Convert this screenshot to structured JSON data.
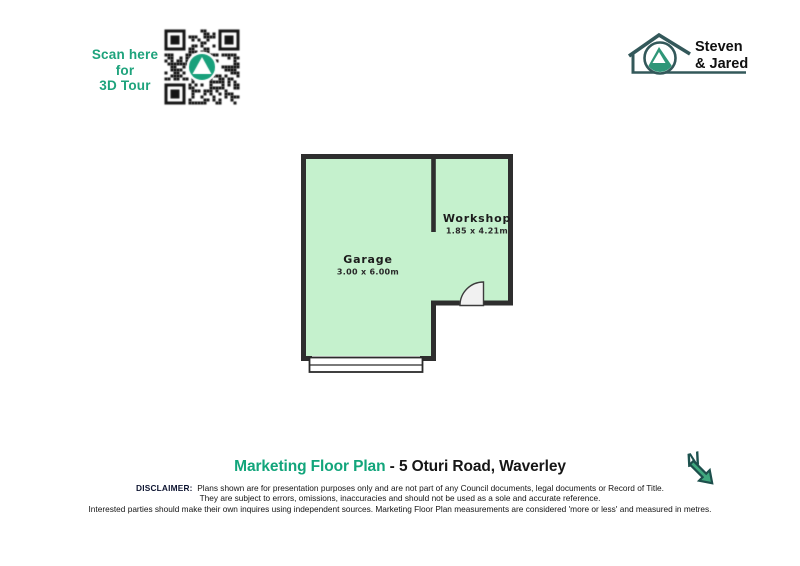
{
  "scan_cta": {
    "lines": [
      "Scan here",
      "for",
      "3D Tour"
    ]
  },
  "qr": {
    "icon": "qr-code-with-mountain-logo"
  },
  "brand": {
    "name_line1": "Steven",
    "name_line2": "& Jared",
    "icon": "house-mountain-logo"
  },
  "floorplan": {
    "rooms": [
      {
        "name": "Garage",
        "dims": "3.00 x 6.00m"
      },
      {
        "name": "Workshop",
        "dims": "1.85 x 4.21m"
      }
    ]
  },
  "footer": {
    "title_highlight": "Marketing Floor Plan",
    "title_rest": "- 5 Oturi Road, Waverley",
    "disclaimer_label": "DISCLAIMER:",
    "disclaimer_lines": [
      "Plans shown are for presentation purposes only and are not part of any Council documents, legal documents or Record of Title.",
      "They are subject to errors, omissions, inaccuracies and should not be used as a sole and accurate reference.",
      "Interested parties should make their own inquires using independent sources.  Marketing Floor Plan measurements are considered 'more or less' and measured in metres."
    ],
    "compass_letter": "N"
  },
  "colors": {
    "accent_teal": "#18a07b",
    "title_green": "#12a57b",
    "floor_fill": "#c5f1cd",
    "wall_dark": "#2e2e2e",
    "logo_dark": "#33585a",
    "mountain_green": "#2f9678"
  }
}
